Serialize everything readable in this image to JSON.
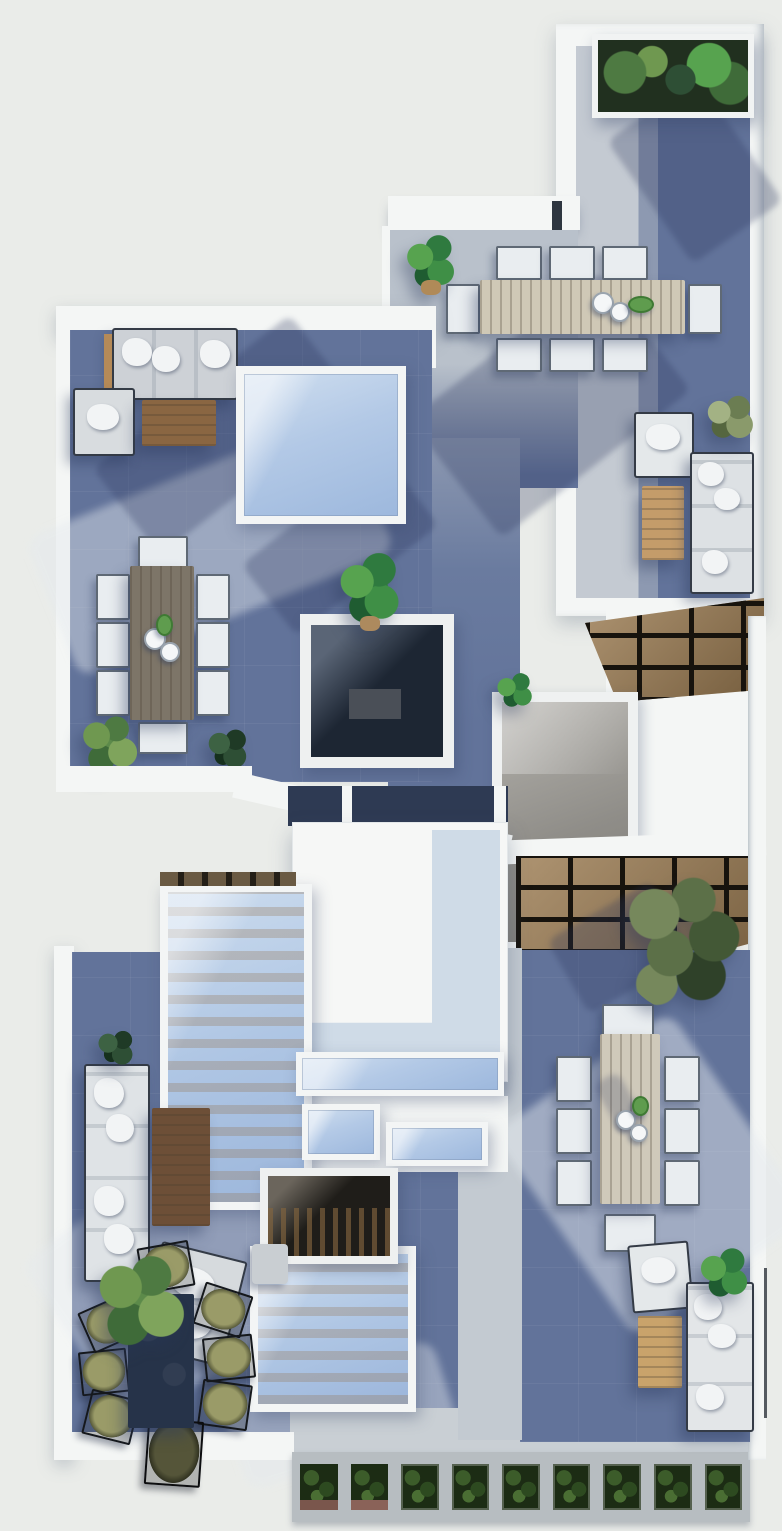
{
  "scene": {
    "title": "Top-down 3D render of a duplex rooftop — two offset terraces with outdoor furniture",
    "style": "photoreal architectural floor-plan render, no text or UI chrome",
    "areas": [
      {
        "name": "upper-right-terrace",
        "features": [
          "white parapet walls",
          "corner planter box with plants",
          "8-seat outdoor dining set",
          "lounge corner with sofa, armchair, coffee table",
          "wood-slat pergola"
        ]
      },
      {
        "name": "upper-left-terrace",
        "features": [
          "L-shaped lounge sofa with white pillows",
          "wood coffee table",
          "armchair",
          "glass skylight box",
          "8-seat gray-wood dining set",
          "shrubs and banana plant",
          "dark courtyard void"
        ]
      },
      {
        "name": "center-roof",
        "features": [
          "large white roof volume",
          "skylight strips",
          "stair skylight with visible wooden stairs",
          "dark slatted light-well",
          "second pergola",
          "gray glazed patio"
        ]
      },
      {
        "name": "lower-left-terrace",
        "features": [
          "vertical sofa",
          "dark wood coffee table",
          "rotated armchair",
          "grass plant",
          "navy dining table with six olive wire chairs"
        ]
      },
      {
        "name": "lower-right-terrace",
        "features": [
          "tree",
          "8-seat light-wood dining set",
          "lounge with sofa, armchair, coffee table",
          "sunlit floor patch"
        ]
      },
      {
        "name": "bottom-edge",
        "features": [
          "walkway",
          "row of nine green planter boxes"
        ]
      }
    ],
    "objects": [
      "planter-box",
      "dining-table",
      "dining-chair",
      "lounge-sofa",
      "armchair",
      "coffee-table",
      "side-table",
      "skylight",
      "stair-skylight",
      "pergola",
      "courtyard-void",
      "light-well",
      "tree",
      "shrub",
      "banana-plant",
      "grass-plant",
      "bowl-set",
      "walkway",
      "parapet-wall"
    ],
    "counts": {
      "dining_sets": 4,
      "skylights": 6,
      "pergolas": 2,
      "sofas": 4,
      "planter_cells": 9
    }
  },
  "palette": {
    "bg": "#eaece9",
    "wall": "#f4f6f5",
    "wall_shade": "#d9dfe3",
    "floor_slate": "#62739a",
    "floor_slate_deep": "#4f6190",
    "floor_sunlit": "#c3c9d2",
    "floor_mid": "#8d99b1",
    "glass": "#aec6e3",
    "glass_light": "#cfdff0",
    "wood": "#b08a58",
    "wood_dark": "#6d4f37",
    "wood_table_gray": "#7d7568",
    "wood_table_light": "#cfc9ba",
    "pergola_wood": "#9c7c52",
    "pergola_gap": "#17130d",
    "void_dark": "#1d2633",
    "cushion": "#dfe3e6",
    "cushion_white": "#f2f4f5",
    "frame_dark": "#343b46",
    "olive": "#8f9060",
    "navy_table": "#263349",
    "foliage": "#4e7a42",
    "foliage_dark": "#24402a",
    "planter_green": "#1c2c14",
    "soil": "#7a564c",
    "shadow": "rgba(38,52,88,0.28)",
    "sunlight": "rgba(228,233,238,0.6)"
  }
}
